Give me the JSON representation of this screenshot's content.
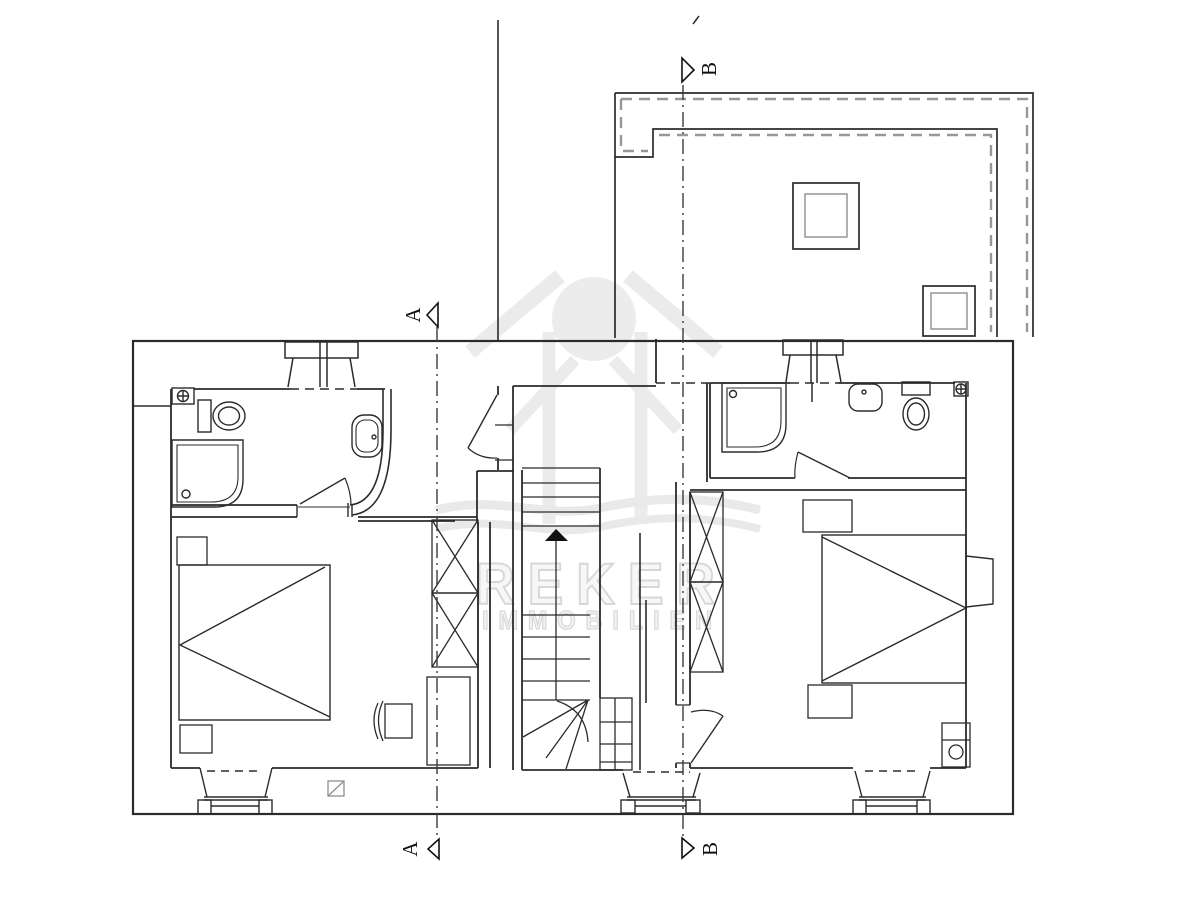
{
  "canvas": {
    "width": 1200,
    "height": 900,
    "background": "#ffffff"
  },
  "colors": {
    "plan_line": "#2b2b2b",
    "hidden_line_gray": "#979797",
    "watermark": "#dcdcdc"
  },
  "watermark": {
    "brand": "REKER",
    "tagline": "IMMOBILIEN"
  },
  "section_markers": {
    "a_top": "A",
    "a_bottom": "A",
    "b_top": "B",
    "b_bottom": "B"
  },
  "plan": {
    "fixture_icons": [
      "toilet-icon",
      "shower-tray-icon",
      "washbasin-icon",
      "vent-crosshair-icon",
      "bed-icon",
      "nightstand-icon",
      "wardrobe-cross-icon",
      "chair-icon",
      "stair-run-icon",
      "stair-up-arrow-icon",
      "skylight-icon",
      "chimney-icon",
      "window-bay-icon",
      "door-swing-icon"
    ]
  }
}
